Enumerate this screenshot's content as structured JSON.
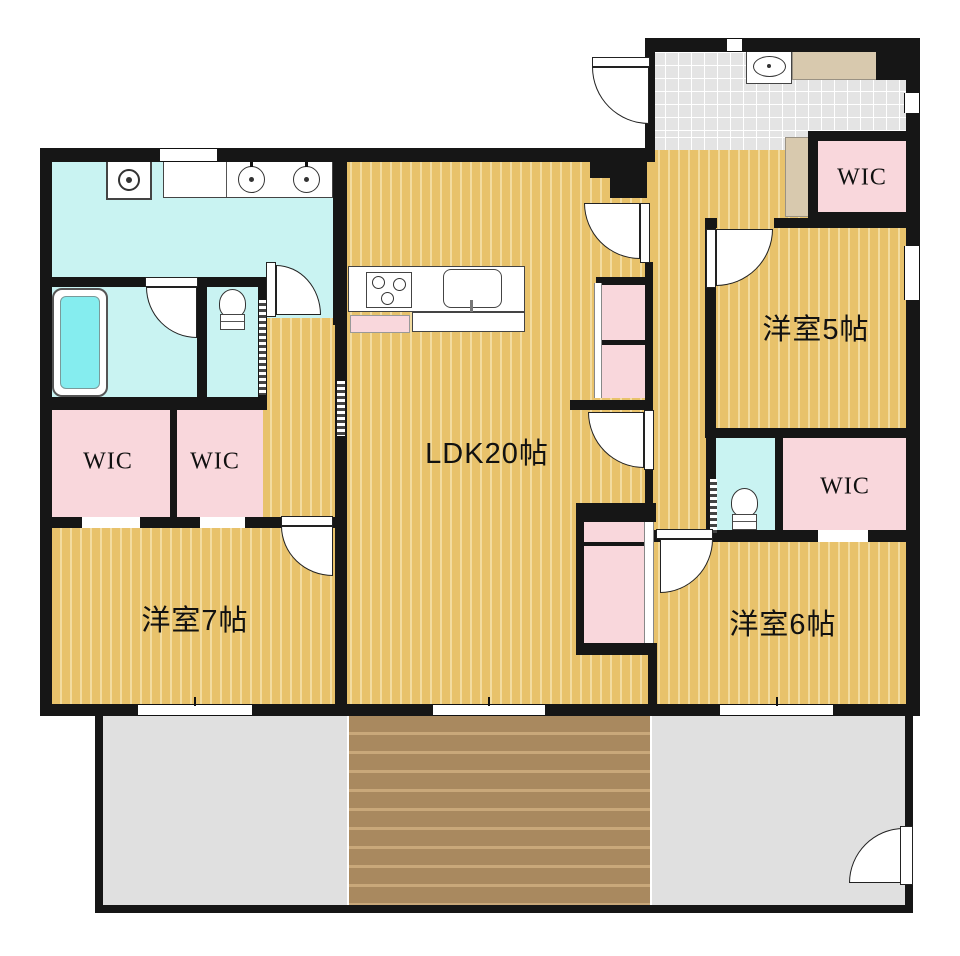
{
  "plan": {
    "title": "apartment-floor-plan",
    "rooms": {
      "ldk": "LDK20帖",
      "western7": "洋室7帖",
      "western6": "洋室6帖",
      "western5": "洋室5帖"
    },
    "wic_labels": [
      "WIC",
      "WIC",
      "WIC",
      "WIC"
    ],
    "colors": {
      "wall": "#161616",
      "wood_floor": "#e8c26b",
      "wood_stripe": "#f3dca0",
      "wet_area_cyan": "#c9f3f2",
      "storage_pink": "#f9d7dc",
      "entrance_tile": "#e4e4e4",
      "balcony_gray": "#e0e0e0",
      "wood_deck": "#a9895f",
      "counter_beige": "#d8c9ae",
      "bathtub_water": "#85edef"
    },
    "fixtures": [
      "bathtub",
      "washing-machine",
      "double-sink-vanity",
      "toilet",
      "toilet",
      "kitchen-stove",
      "kitchen-sink",
      "entrance-sink",
      "shoe-cabinet"
    ]
  }
}
